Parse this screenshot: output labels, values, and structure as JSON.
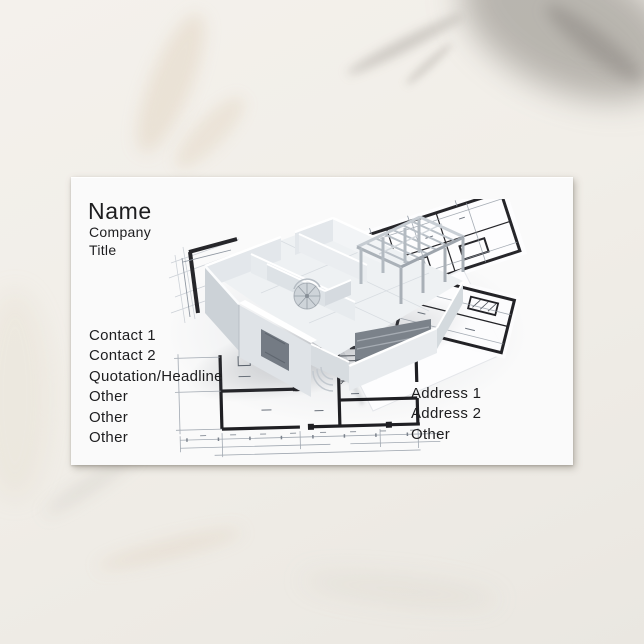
{
  "scene": {
    "background_texture": "white-marble-surface",
    "marble_base_color": "#f2efe9",
    "marble_vein_gray": "#6c6660",
    "marble_vein_tan": "#c1a374"
  },
  "card": {
    "background_color": "#fafafa",
    "text_color": "#1d1d1f",
    "name": "Name",
    "company": "Company",
    "title": "Title",
    "contact_lines": [
      "Contact 1",
      "Contact 2",
      "Quotation/Headline",
      "Other",
      "Other",
      "Other"
    ],
    "address_lines": [
      "Address 1",
      "Address 2",
      "Other"
    ],
    "photo": {
      "name": "house-blueprint-photo",
      "subject": "3D architectural model of a roofless house standing on rotated blueprint floor-plan sheets",
      "ink_color": "#1f1f23",
      "detail_line_color": "#98a0aa"
    }
  }
}
